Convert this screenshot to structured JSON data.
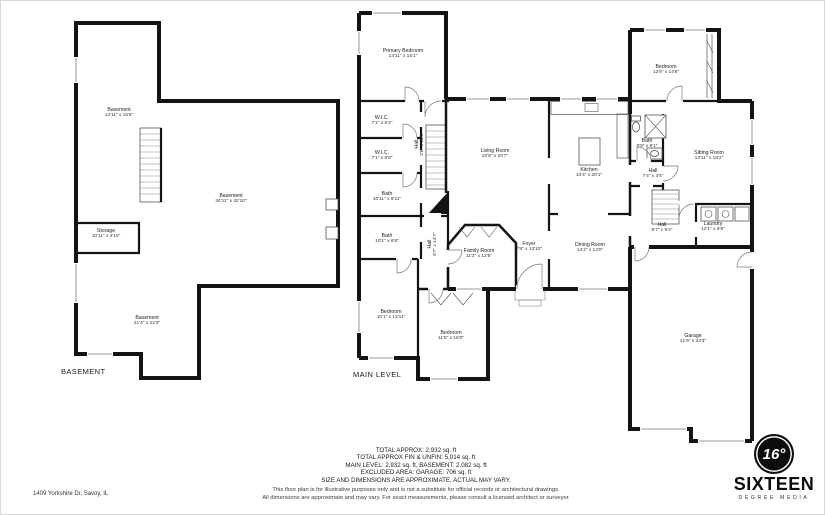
{
  "meta": {
    "address": "1409 Yorkshire Dr, Savoy, IL"
  },
  "levels": {
    "basement": {
      "title": "BASEMENT",
      "rooms": [
        {
          "name": "Basement",
          "dims": "14'11\" x 15'6\"",
          "x": 118,
          "y": 112
        },
        {
          "name": "Basement",
          "dims": "34'11\" x 32'10\"",
          "x": 230,
          "y": 198
        },
        {
          "name": "Storage",
          "dims": "10'11\" x 4'10\"",
          "x": 105,
          "y": 233
        },
        {
          "name": "Basement",
          "dims": "21'4\" x 22'3\"",
          "x": 146,
          "y": 320
        }
      ]
    },
    "main": {
      "title": "MAIN LEVEL",
      "rooms": [
        {
          "name": "Primary Bedroom",
          "dims": "14'11\" x 15'1\"",
          "x": 402,
          "y": 53
        },
        {
          "name": "W.I.C.",
          "dims": "7'1\" x 6'4\"",
          "x": 381,
          "y": 120
        },
        {
          "name": "W.I.C.",
          "dims": "7'1\" x 6'8\"",
          "x": 381,
          "y": 155
        },
        {
          "name": "Bath",
          "dims": "10'11\" x 8'11\"",
          "x": 386,
          "y": 196
        },
        {
          "name": "Bath",
          "dims": "10'1\" x 6'6\"",
          "x": 386,
          "y": 238
        },
        {
          "name": "Hall",
          "dims": "3'6\" x 14'1\"",
          "x": 419,
          "y": 143,
          "rot": true
        },
        {
          "name": "Living Room",
          "dims": "22'6\" x 20'7\"",
          "x": 494,
          "y": 153
        },
        {
          "name": "Kitchen",
          "dims": "14'4\" x 20'1\"",
          "x": 588,
          "y": 172
        },
        {
          "name": "Family Room",
          "dims": "11'3\" x 12'6\"",
          "x": 478,
          "y": 253
        },
        {
          "name": "Foyer",
          "dims": "7'8\" x 13'10\"",
          "x": 528,
          "y": 246
        },
        {
          "name": "Hall",
          "dims": "9'7\" x 13'7\"",
          "x": 432,
          "y": 243,
          "rot": true
        },
        {
          "name": "Dining Room",
          "dims": "14'4\" x 13'0\"",
          "x": 589,
          "y": 247
        },
        {
          "name": "Bedroom",
          "dims": "10'1\" x 13'11\"",
          "x": 390,
          "y": 314
        },
        {
          "name": "Bedroom",
          "dims": "11'6\" x 16'0\"",
          "x": 450,
          "y": 335
        },
        {
          "name": "Bedroom",
          "dims": "12'9\" x 14'8\"",
          "x": 665,
          "y": 69
        },
        {
          "name": "Bath",
          "dims": "6'9\" x 9'1\"",
          "x": 646,
          "y": 143
        },
        {
          "name": "Sitting Room",
          "dims": "13'11\" x 18'2\"",
          "x": 708,
          "y": 155
        },
        {
          "name": "Hall",
          "dims": "7'4\" x 3'6\"",
          "x": 652,
          "y": 173
        },
        {
          "name": "Hall",
          "dims": "8'7\" x 9'4\"",
          "x": 661,
          "y": 227
        },
        {
          "name": "Laundry",
          "dims": "12'1\" x 6'9\"",
          "x": 712,
          "y": 226
        },
        {
          "name": "Garage",
          "dims": "21'9\" x 34'3\"",
          "x": 692,
          "y": 338
        }
      ]
    }
  },
  "summary": {
    "lines": [
      "TOTAL APPROX: 2,932 sq. ft",
      "TOTAL APPROX FIN & UNFIN: 5,014 sq. ft",
      "MAIN LEVEL: 2,932 sq. ft, BASEMENT: 2,082 sq. ft",
      "EXCLUDED AREA: GARAGE: 706 sq. ft",
      "SIZE AND DIMENSIONS ARE APPROXIMATE, ACTUAL MAY VARY."
    ],
    "disclaimer": [
      "This floor plan is for illustrative purposes only and is not a substitute for official records or architectural drawings.",
      "All dimensions are approximate and may vary. For exact measurements, please consult a licensed architect or surveyor."
    ]
  },
  "branding": {
    "icon_text": "16°",
    "name": "SIXTEEN",
    "tagline": "DEGREE MEDIA"
  },
  "colors": {
    "wall": "#141414",
    "window_line": "#9a9a9a",
    "background": "#ffffff"
  }
}
